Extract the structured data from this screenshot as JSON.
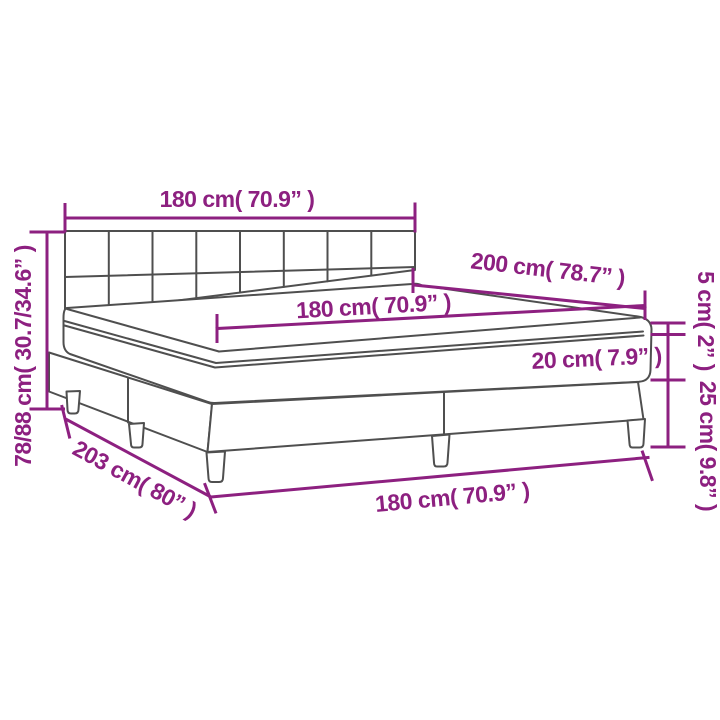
{
  "diagram": {
    "description": "box spring bed with tufted headboard, mattress and topper - dimension drawing",
    "accent_color": "#8D2080",
    "line_color": "#4F4F4F",
    "labels": {
      "headboard_width": "180 cm( 70.9” )",
      "total_height": "78/88 cm( 30.7/34.6” )",
      "mattress_length": "200 cm( 78.7” )",
      "mattress_width": "180 cm( 70.9” )",
      "topper_height": "5 cm( 2” )",
      "mattress_height": "20 cm( 7.9” )",
      "base_height": "25 cm( 9.8” )",
      "base_length": "203 cm( 80” )",
      "base_width": "180 cm( 70.9” )"
    }
  }
}
